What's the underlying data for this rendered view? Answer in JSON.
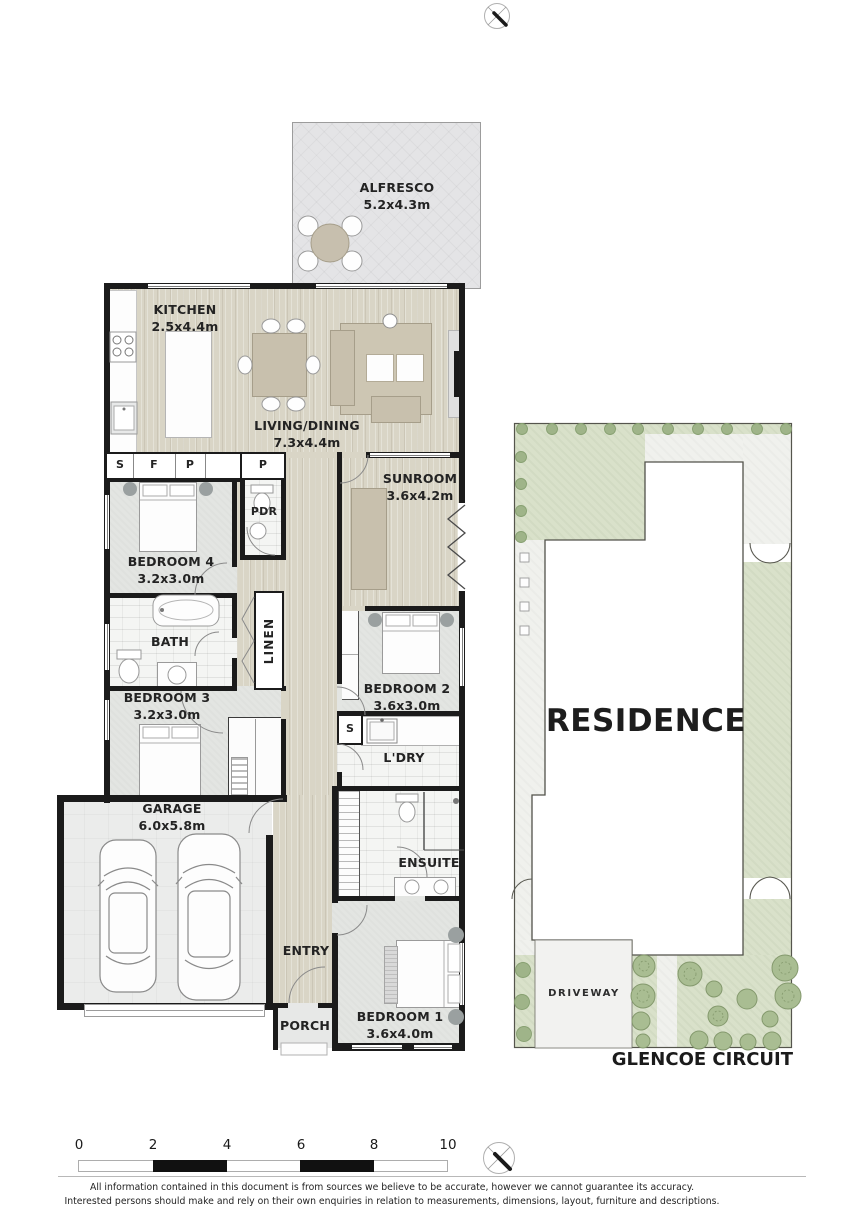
{
  "plan": {
    "alfresco": {
      "name": "ALFRESCO",
      "dims": "5.2x4.3m"
    },
    "kitchen": {
      "name": "KITCHEN",
      "dims": "2.5x4.4m"
    },
    "living_dining": {
      "name": "LIVING/DINING",
      "dims": "7.3x4.4m"
    },
    "sunroom": {
      "name": "SUNROOM",
      "dims": "3.6x4.2m"
    },
    "powder": {
      "name": "PDR"
    },
    "bedroom4": {
      "name": "BEDROOM 4",
      "dims": "3.2x3.0m"
    },
    "bath": {
      "name": "BATH"
    },
    "linen": {
      "name": "LINEN"
    },
    "bedroom3": {
      "name": "BEDROOM 3",
      "dims": "3.2x3.0m"
    },
    "bedroom2": {
      "name": "BEDROOM 2",
      "dims": "3.6x3.0m"
    },
    "laundry": {
      "name": "L'DRY"
    },
    "garage": {
      "name": "GARAGE",
      "dims": "6.0x5.8m"
    },
    "ensuite": {
      "name": "ENSUITE"
    },
    "entry": {
      "name": "ENTRY"
    },
    "porch": {
      "name": "PORCH"
    },
    "bedroom1": {
      "name": "BEDROOM 1",
      "dims": "3.6x4.0m"
    },
    "cupboards": {
      "store": "S",
      "fridge": "F",
      "pantry1": "P",
      "pantry2": "P",
      "laundry_store": "S"
    }
  },
  "site": {
    "residence_label": "RESIDENCE",
    "driveway_label": "DRIVEWAY",
    "street_label": "GLENCOE CIRCUIT"
  },
  "scale_bar": {
    "ticks": [
      "0",
      "2",
      "4",
      "6",
      "8",
      "10"
    ]
  },
  "footer": {
    "disclaimer_line1": "All information contained in this document is from sources we believe to be accurate, however we cannot guarantee its accuracy.",
    "disclaimer_line2": "Interested persons should make and rely on their own enquiries in relation to measurements, dimensions, layout, furniture and descriptions."
  },
  "colors": {
    "wall": "#1b1b1b",
    "timber": "#d9d5c6",
    "carpet": "#e3e5e2",
    "tile": "#f4f5f3",
    "grass": "#d9e1ca",
    "path": "#f0f1ed",
    "furniture_tan": "#c8c0ad"
  }
}
